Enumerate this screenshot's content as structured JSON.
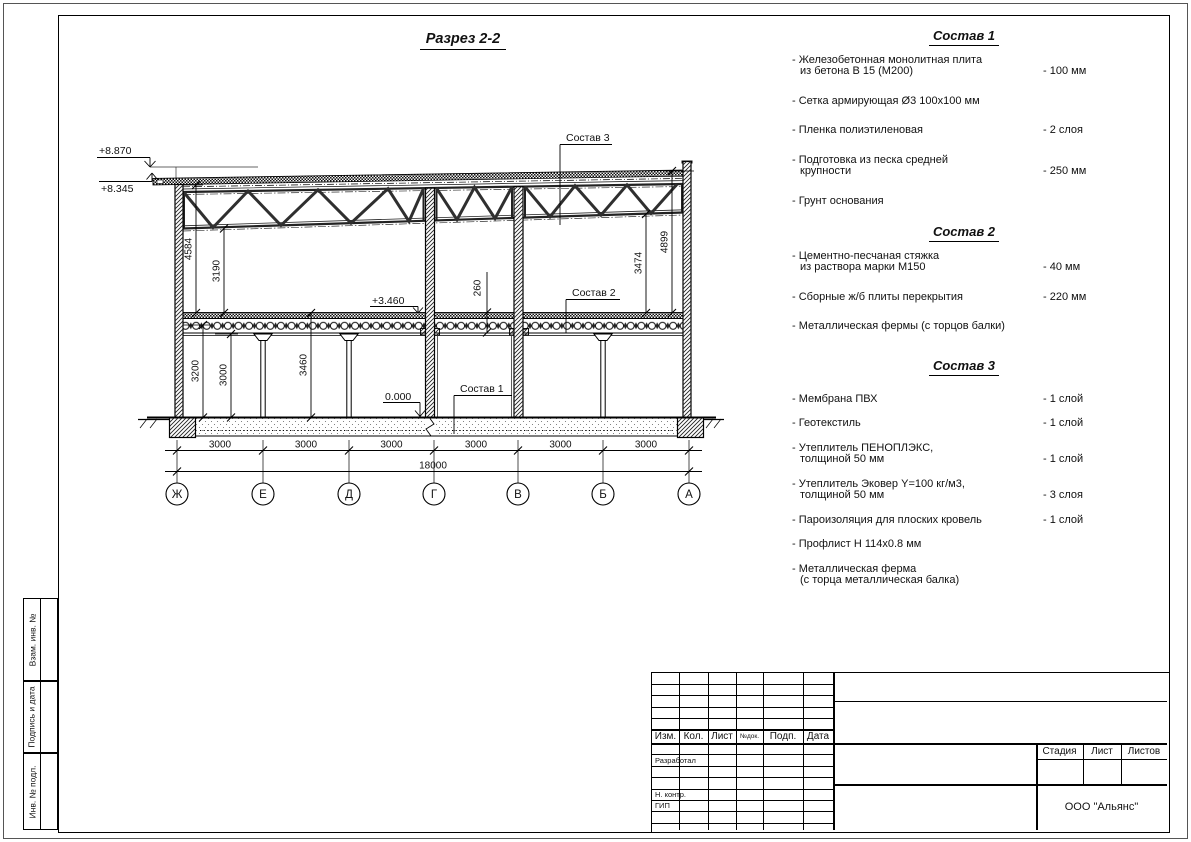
{
  "drawing": {
    "title": "Разрез 2-2",
    "levels": {
      "roof_high": "+8.870",
      "roof_low": "+8.345",
      "floor2": "+3.460",
      "floor1": "0.000"
    },
    "vdims": {
      "d4584": "4584",
      "d3190": "3190",
      "d3474": "3474",
      "d4899": "4899",
      "d3200": "3200",
      "d3000": "3000",
      "d3460": "3460",
      "d260": "260"
    },
    "hdims": {
      "spans": [
        "3000",
        "3000",
        "3000",
        "3000",
        "3000",
        "3000"
      ],
      "total": "18000"
    },
    "axes": [
      "Ж",
      "Е",
      "Д",
      "Г",
      "В",
      "Б",
      "А"
    ],
    "callouts": {
      "c1": "Состав 1",
      "c2": "Состав 2",
      "c3": "Состав 3"
    }
  },
  "compositions": [
    {
      "title": "Состав 1",
      "items": [
        {
          "text": "- Железобетонная  монолитная плита\nиз бетона В 15 (М200)",
          "value": "- 100 мм"
        },
        {
          "text": "- Сетка армирующая Ø3 100х100 мм",
          "value": ""
        },
        {
          "text": "- Пленка полиэтиленовая",
          "value": "-  2 слоя"
        },
        {
          "text": "- Подготовка из песка средней\nкрупности",
          "value": "- 250 мм"
        },
        {
          "text": "- Грунт основания",
          "value": ""
        }
      ]
    },
    {
      "title": "Состав 2",
      "items": [
        {
          "text": "- Цементно-песчаная стяжка\nиз раствора марки М150",
          "value": "- 40 мм"
        },
        {
          "text": "- Сборные ж/б плиты перекрытия",
          "value": "- 220 мм"
        },
        {
          "text": "- Металлическая фермы (с торцов балки)",
          "value": ""
        }
      ]
    },
    {
      "title": "Состав 3",
      "items": [
        {
          "text": "- Мембрана ПВХ",
          "value": "- 1 слой"
        },
        {
          "text": "- Геотекстиль",
          "value": "- 1 слой"
        },
        {
          "text": "- Утеплитель ПЕНОПЛЭКС,\nтолщиной 50 мм",
          "value": "- 1 слой"
        },
        {
          "text": "- Утеплитель Эковер Y=100 кг/м3,\nтолщиной 50 мм",
          "value": "- 3 слоя"
        },
        {
          "text": "- Пароизоляция для плоских кровель",
          "value": "- 1 слой"
        },
        {
          "text": "- Профлист Н 114х0.8 мм",
          "value": ""
        },
        {
          "text": "- Металлическая ферма\n(с торца металлическая балка)",
          "value": ""
        }
      ]
    }
  ],
  "sidebar": {
    "labels": [
      "Взам. инв. №",
      "Подпись и дата",
      "Инв. № подл."
    ]
  },
  "titleblock": {
    "headers": [
      "Изм.",
      "Кол.",
      "Лист",
      "№док.",
      "Подп.",
      "Дата"
    ],
    "rows": [
      "Разработал",
      "Н. контр.",
      "ГИП"
    ],
    "stage_headers": [
      "Стадия",
      "Лист",
      "Листов"
    ],
    "company": "ООО \"Альянс\""
  }
}
